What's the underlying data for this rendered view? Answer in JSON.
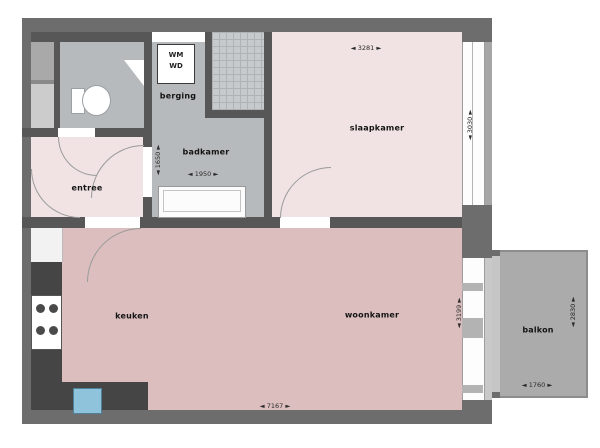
{
  "floorplan": {
    "type": "apartment-floorplan",
    "rooms": {
      "entree": {
        "label": "entree"
      },
      "badkamer": {
        "label": "badkamer"
      },
      "berging": {
        "label": "berging"
      },
      "slaapkamer": {
        "label": "slaapkamer"
      },
      "keuken": {
        "label": "keuken"
      },
      "woonkamer": {
        "label": "woonkamer"
      },
      "balkon": {
        "label": "balkon"
      }
    },
    "appliance_box": {
      "line1": "WM",
      "line2": "WD"
    },
    "dimensions": {
      "slaapkamer_width": "◄ 3281 ►",
      "slaapkamer_depth": "◄ 3030 ►",
      "badkamer_depth": "◄ 1650 ►",
      "badkamer_width": "◄ 1950 ►",
      "woonkamer_width": "◄ 7167 ►",
      "woonkamer_depth": "◄ 3199 ►",
      "balkon_depth": "◄ 2830 ►",
      "balkon_width": "◄ 1760 ►"
    },
    "colors": {
      "wall": "#6d6d6d",
      "inner_wall": "#575757",
      "room_pink_light": "#f1e3e3",
      "room_pink_rose": "#dcbebe",
      "wet_room_gray": "#b7babc",
      "balcony_gray": "#ababab",
      "counter_dark": "#454545",
      "sink_blue": "#8fc3dc"
    }
  }
}
